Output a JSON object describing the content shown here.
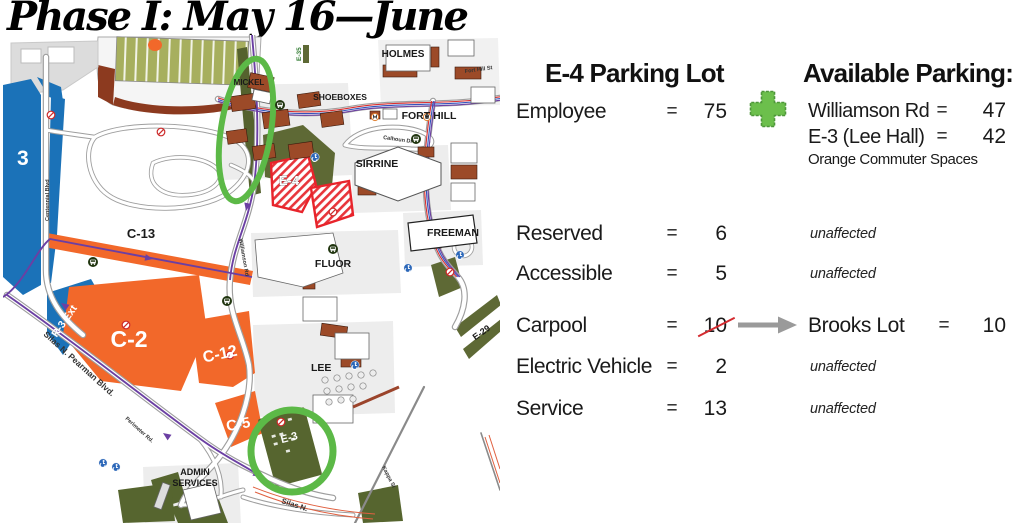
{
  "title": "Phase I: May 16—June",
  "panel": {
    "left_heading": "E-4 Parking Lot",
    "right_heading": "Available Parking:",
    "eq": "=",
    "rows": {
      "employee": {
        "label": "Employee",
        "value": "75"
      },
      "reserved": {
        "label": "Reserved",
        "value": "6"
      },
      "accessible": {
        "label": "Accessible",
        "value": "5"
      },
      "carpool": {
        "label": "Carpool",
        "value": "10"
      },
      "electric": {
        "label": "Electric Vehicle",
        "value": "2"
      },
      "service": {
        "label": "Service",
        "value": "13"
      }
    },
    "available": {
      "row1": {
        "label": "Williamson Rd",
        "value": "47"
      },
      "row2": {
        "label": "E-3 (Lee Hall)",
        "value": "42"
      },
      "note": "Orange Commuter Spaces"
    },
    "brooks": {
      "label": "Brooks Lot",
      "value": "10"
    },
    "unaffected": "unaffected"
  },
  "map": {
    "lots": {
      "l3": "3",
      "c13": "C-13",
      "r3ext": "R-3 Ext",
      "c2": "C-2",
      "c12": "C-12",
      "c5": "C-5",
      "e3": "E-3",
      "e4": "E-4",
      "e29": "E-29",
      "e35": "E-35"
    },
    "buildings": {
      "mickel": "MICKEL",
      "holmes": "HOLMES",
      "shoeboxes": "SHOEBOXES",
      "forthill": "FORT HILL",
      "sirrine": "SIRRINE",
      "freeman": "FREEMAN",
      "fluor": "FLUOR",
      "lee": "LEE",
      "admin1": "ADMIN",
      "admin2": "SERVICES"
    },
    "roads": {
      "forthillst": "Fort Hill St",
      "calhoun": "Calhoun Dr",
      "centennial": "Centennial Blvd",
      "williamson": "Williamson Rd",
      "pearman": "Silas N. Pearman Blvd.",
      "perimeter": "Perimeter Rd.",
      "kappa": "Kappa St",
      "silas": "Silas N."
    }
  },
  "colors": {
    "lot_orange": "#F2682A",
    "lot_blue": "#1B72B8",
    "lot_olive": "#56652F",
    "highlight_green": "#5CB947",
    "hatch_red": "#E8242B",
    "route_purple": "#6B3FA3",
    "plus_green": "#6CBF4C",
    "arrow_gray": "#9A9A9A",
    "slash_red": "#D42B30"
  }
}
